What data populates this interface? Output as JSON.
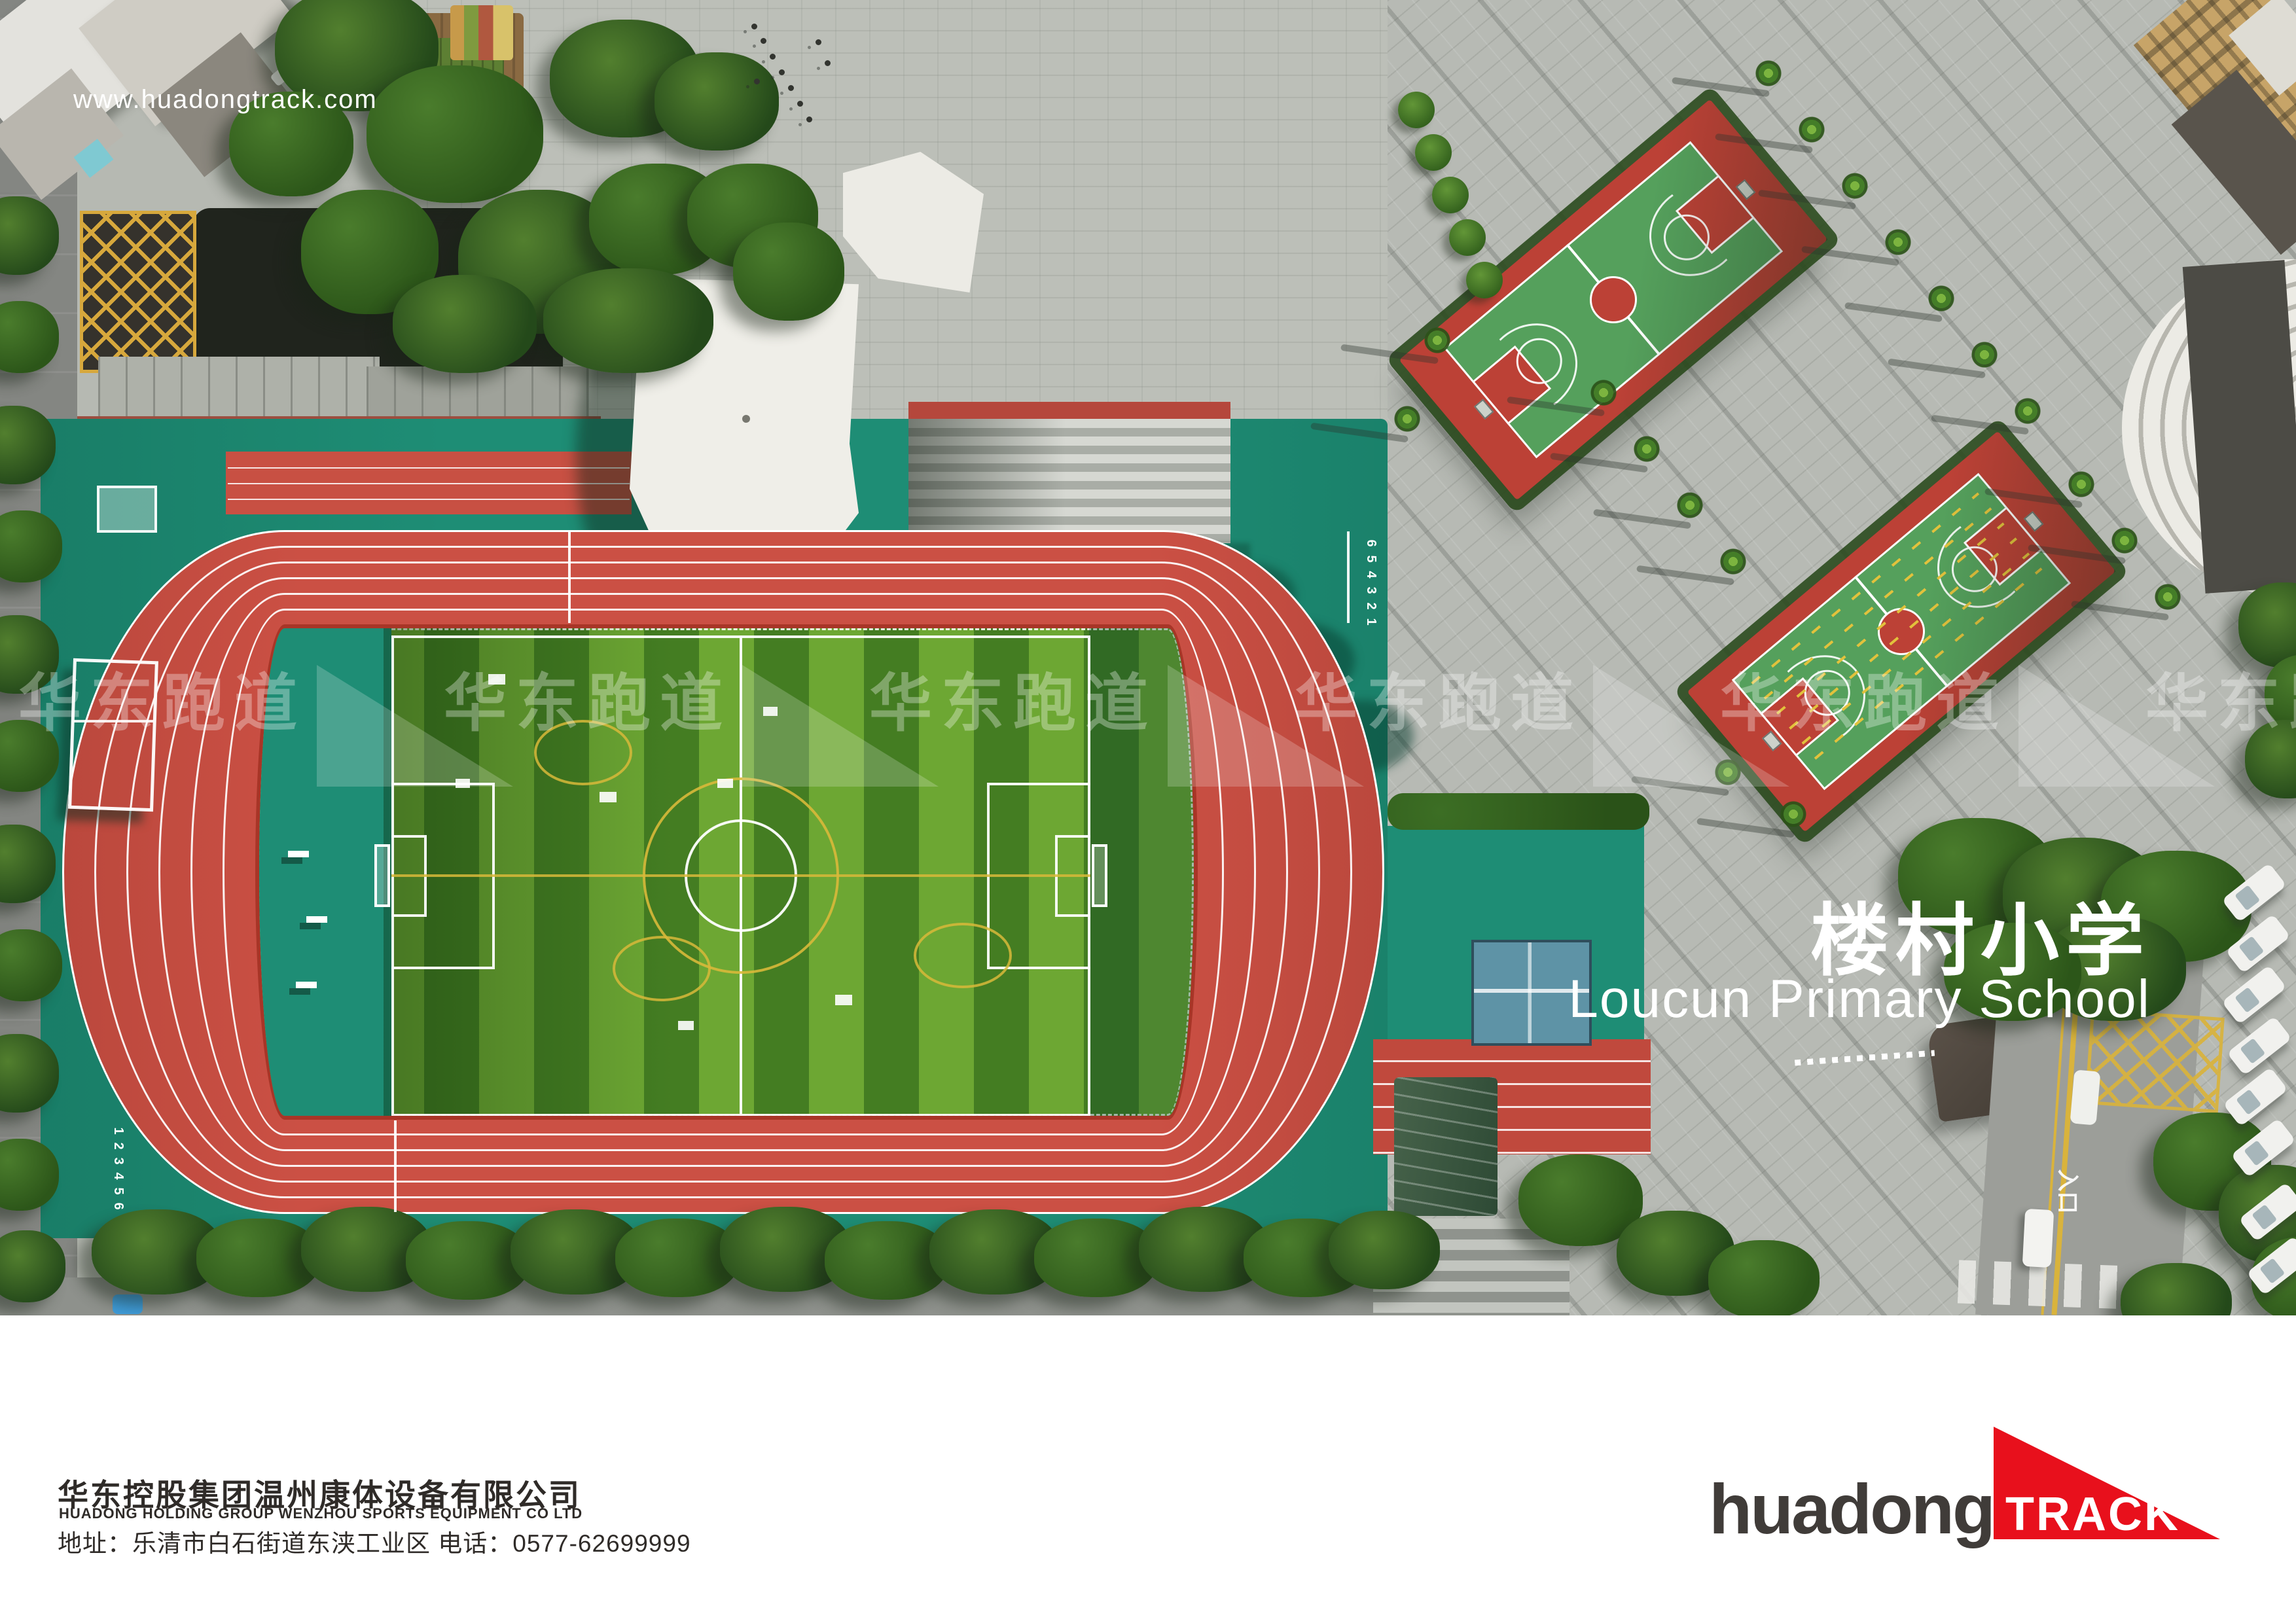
{
  "photo": {
    "url_watermark": "www.huadongtrack.com",
    "school_title_cn": "楼村小学",
    "school_title_en": "Loucun Primary School",
    "repeat_watermark_text": "华东跑道",
    "track_finish_lane_numbers": [
      "6",
      "5",
      "4",
      "3",
      "2",
      "1"
    ],
    "track_start_lane_numbers": [
      "1",
      "2",
      "3",
      "4",
      "5",
      "6"
    ],
    "road_entrance_label": "入口"
  },
  "footer": {
    "company_cn": "华东控股集团温州康体设备有限公司",
    "company_en": "HUADONG HOLDING GROUP WENZHOU SPORTS EQUIPMENT CO LTD",
    "contact_line": "地址：乐清市白石街道东浃工业区  电话：0577-62699999",
    "logo_text": "huadong",
    "logo_accent_text": "TRACK"
  },
  "colors": {
    "accent_red": "#e8101c",
    "track_red": "#cb5044",
    "apron_teal": "#1e8d75",
    "grass_light": "#6da733",
    "grass_dark": "#447d22",
    "court_red": "#bc4136",
    "court_green": "#55a05c",
    "plaza_gray": "#b6b9b2"
  }
}
